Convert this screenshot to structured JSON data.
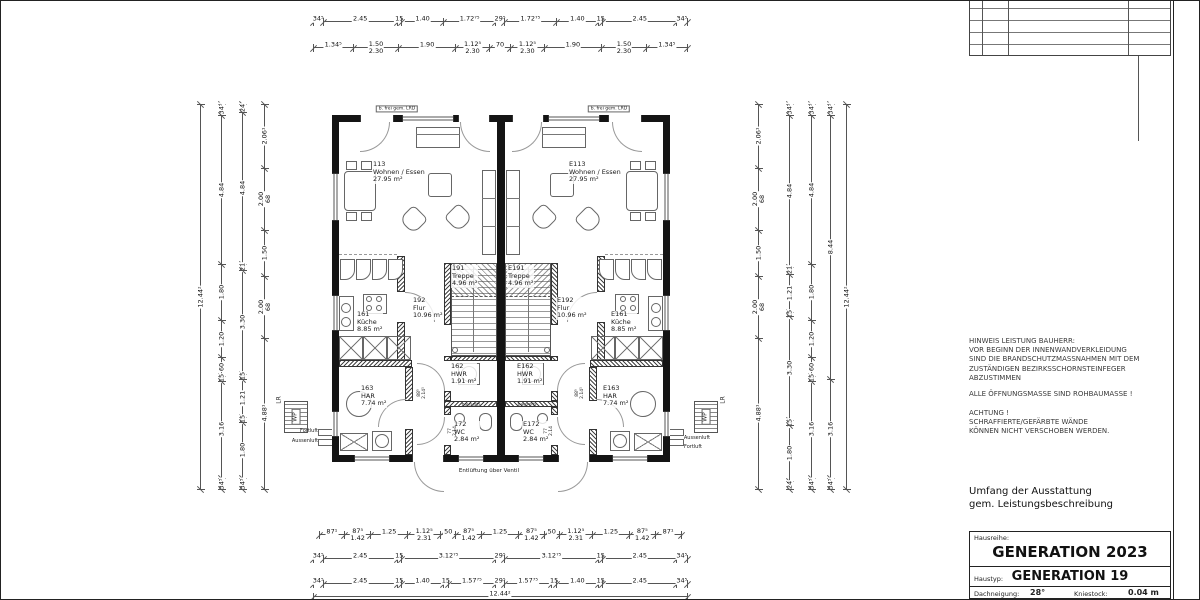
{
  "sheet": {
    "background": "#ffffff",
    "line_color": "#222222"
  },
  "title_block": {
    "hausreihe_label": "Hausreihe:",
    "hausreihe_value": "GENERATION 2023",
    "haustyp_label": "Haustyp:",
    "haustyp_value": "GENERATION 19",
    "dachneigung_label": "Dachneigung:",
    "dachneigung_value": "28°",
    "kniestock_label": "Kniestock:",
    "kniestock_value": "0.04 m",
    "plan_label": "Plan:",
    "massstab_label": "Maßstab:"
  },
  "notes": {
    "hinweis": "HINWEIS LEISTUNG BAUHERR:\nVOR BEGINN DER INNENWANDVERKLEIDUNG\nSIND DIE BRANDSCHUTZMASSNAHMEN MIT DEM\nZUSTÄNDIGEN BEZIRKSSCHORNSTEINFEGER\nABZUSTIMMEN",
    "oeffnung": "ALLE ÖFFNUNGSMASSE SIND ROHBAUMASSE !",
    "achtung": "ACHTUNG !\nSCHRAFFIERTE/GEFÄRBTE WÄNDE\nKÖNNEN NICHT VERSCHOBEN WERDEN.",
    "umfang": "Umfang der Ausstattung\ngem. Leistungsbeschreibung"
  },
  "rooms": {
    "left": [
      {
        "num": "113",
        "name": "Wohnen / Essen",
        "area": "27.95 m²"
      },
      {
        "num": "161",
        "name": "Küche",
        "area": "8.85 m²"
      },
      {
        "num": "192",
        "name": "Flur",
        "area": "10.96 m²"
      },
      {
        "num": "191",
        "name": "Treppe",
        "area": "4.96 m²"
      },
      {
        "num": "162",
        "name": "HWR",
        "area": "1.91 m²"
      },
      {
        "num": "163",
        "name": "HAR",
        "area": "7.74 m²"
      },
      {
        "num": "172",
        "name": "WC",
        "area": "2.84 m²"
      }
    ],
    "right": [
      {
        "num": "E113",
        "name": "Wohnen / Essen",
        "area": "27.95 m²"
      },
      {
        "num": "E161",
        "name": "Küche",
        "area": "8.85 m²"
      },
      {
        "num": "E192",
        "name": "Flur",
        "area": "10.96 m²"
      },
      {
        "num": "E191",
        "name": "Treppe",
        "area": "4.96 m²"
      },
      {
        "num": "E162",
        "name": "HWR",
        "area": "1.91 m²"
      },
      {
        "num": "E163",
        "name": "HAR",
        "area": "7.74 m²"
      },
      {
        "num": "E172",
        "name": "WC",
        "area": "2.84 m²"
      }
    ]
  },
  "plan_annotations": {
    "entlueftung": "Entlüftung über Ventil",
    "lrd_box": "b. frei gem. LRD",
    "wp": "WP",
    "lr": "LR",
    "fortluft": "Fortluft",
    "aussenluft": "Aussenluft",
    "bauseits": "bauseits"
  },
  "door_dims": [
    "88⁵\n2.14¹",
    "77\n2.14"
  ],
  "dimensions": {
    "top1": [
      "34⁵",
      "2.45",
      "15",
      "1.40",
      "1.72⁷⁵",
      "29⁵",
      "1.72⁷⁵",
      "1.40",
      "15",
      "2.45",
      "34⁵"
    ],
    "top2": [
      "1.34⁵",
      "1.50\n2.30",
      "1.90",
      "1.12⁵\n2.30",
      "70",
      "1.12⁵\n2.30",
      "1.90",
      "1.50\n2.30",
      "1.34⁵"
    ],
    "bottom1": [
      "87¹",
      "87⁵\n1.42",
      "1.25",
      "1.12⁵\n2.31",
      "50",
      "87⁵\n1.42",
      "1.25",
      "87⁵\n1.42",
      "50",
      "1.12⁵\n2.31",
      "1.25",
      "87⁵\n1.42",
      "87¹"
    ],
    "bottom2": [
      "34⁵",
      "2.45",
      "15",
      "3.12⁷⁵",
      "29⁵",
      "3.12⁷⁵",
      "15",
      "2.45",
      "34⁵"
    ],
    "bottom3": [
      "34⁵",
      "2.45",
      "15",
      "1.40",
      "15",
      "1.57⁷⁵",
      "29⁵",
      "1.57⁷⁵",
      "15",
      "1.40",
      "15",
      "2.45",
      "34⁵"
    ],
    "bottom_total": [
      "12.44²"
    ],
    "left1": [
      "34⁵",
      "4.84",
      "1.80",
      "1.20",
      "60",
      "15",
      "3.16",
      "34⁵"
    ],
    "left2": [
      "24",
      "4.84",
      "21",
      "3.30",
      "15",
      "1.21",
      "15",
      "1.80",
      "34⁵"
    ],
    "left3": [
      "2.06¹",
      "2.00\n68",
      "1.50",
      "2.00\n68",
      "4.88¹"
    ],
    "left_total": [
      "12.44²"
    ],
    "right1": [
      "2.06¹",
      "2.00\n68",
      "1.50",
      "2.00\n68",
      "4.88¹"
    ],
    "right2": [
      "34⁵",
      "4.84",
      "21",
      "1.21",
      "15",
      "3.30",
      "15",
      "1.80",
      "24"
    ],
    "right3": [
      "34⁵",
      "4.84",
      "1.80",
      "1.20",
      "60",
      "15",
      "3.16",
      "34⁵"
    ],
    "right4": [
      "34⁵",
      "8.44",
      "3.16",
      "34⁵"
    ],
    "right_total": [
      "12.44²"
    ]
  }
}
